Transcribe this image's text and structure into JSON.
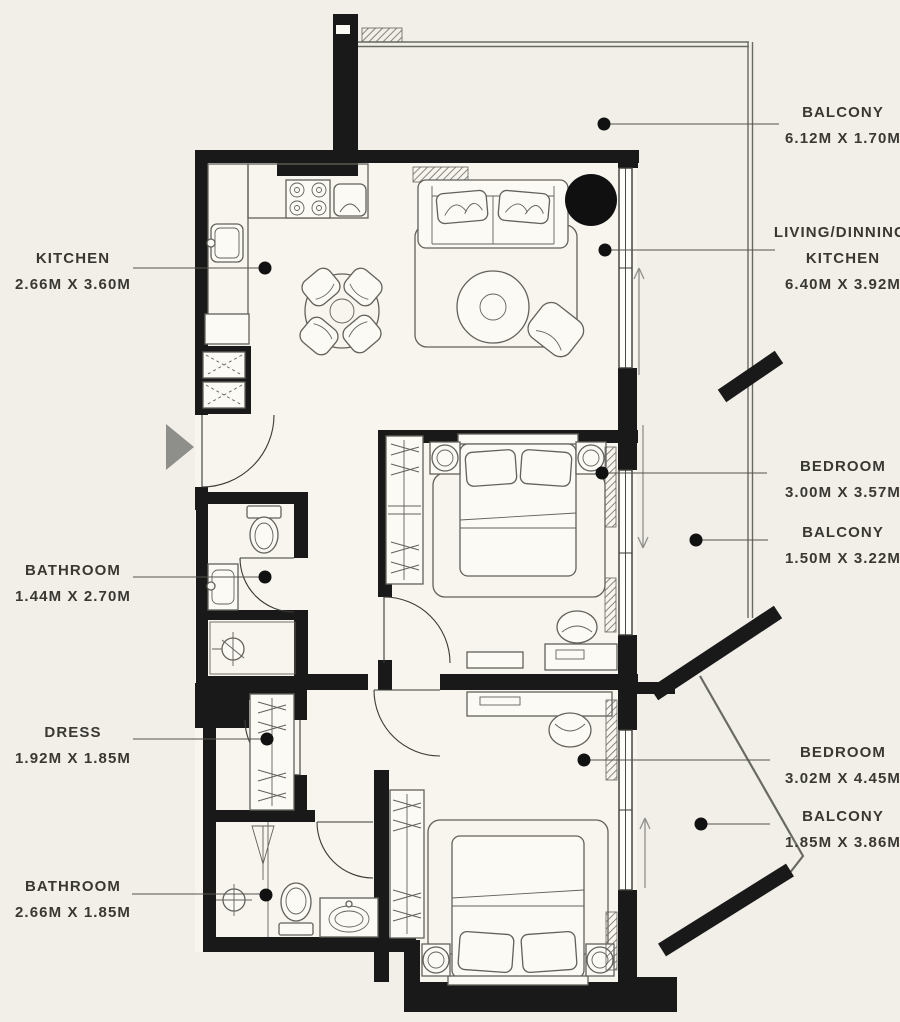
{
  "plan_title": "Apartment Floor Plan",
  "colors": {
    "background": "#f1efe8",
    "floor": "#f7f5ee",
    "wall": "#191919",
    "furniture_line": "#63615a",
    "thin_line": "#3a3a35",
    "label": "#3a3832",
    "leader": "#55534c",
    "arrow_gray": "#8f8f8c",
    "entry_triangle": "#8e8e8a"
  },
  "icons": {
    "entry-arrow": "gray-right-triangle",
    "plant": "filled-black-circle",
    "direction-arrow": "thin-line-arrow",
    "leader-dot": "filled-black-dot"
  },
  "labels": [
    {
      "id": "balcony-top",
      "side": "right",
      "lines": [
        "BALCONY"
      ],
      "dims": "6.12M X 1.70M"
    },
    {
      "id": "living-dining-kitchen",
      "side": "right",
      "lines": [
        "LIVING/DINNING/",
        "KITCHEN"
      ],
      "dims": "6.40M X 3.92M"
    },
    {
      "id": "kitchen",
      "side": "left",
      "lines": [
        "KITCHEN"
      ],
      "dims": "2.66M X 3.60M"
    },
    {
      "id": "bedroom-1",
      "side": "right",
      "lines": [
        "BEDROOM"
      ],
      "dims": "3.00M X 3.57M"
    },
    {
      "id": "balcony-middle",
      "side": "right",
      "lines": [
        "BALCONY"
      ],
      "dims": "1.50M X 3.22M"
    },
    {
      "id": "bathroom-1",
      "side": "left",
      "lines": [
        "BATHROOM"
      ],
      "dims": "1.44M X 2.70M"
    },
    {
      "id": "dress",
      "side": "left",
      "lines": [
        "DRESS"
      ],
      "dims": "1.92M X 1.85M"
    },
    {
      "id": "bedroom-2",
      "side": "right",
      "lines": [
        "BEDROOM"
      ],
      "dims": "3.02M X 4.45M"
    },
    {
      "id": "balcony-bottom",
      "side": "right",
      "lines": [
        "BALCONY"
      ],
      "dims": "1.85M X 3.86M"
    },
    {
      "id": "bathroom-2",
      "side": "left",
      "lines": [
        "BATHROOM"
      ],
      "dims": "2.66M X 1.85M"
    }
  ]
}
